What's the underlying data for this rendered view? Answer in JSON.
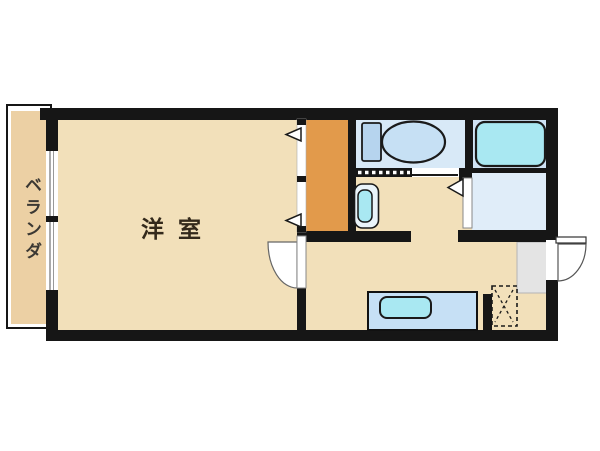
{
  "title": "apartment-floor-plan",
  "labels": {
    "western_room": "洋室",
    "balcony": "ベランダ"
  },
  "fixtures": [
    "toilet-icon",
    "bathtub-icon",
    "washbasin-icon",
    "kitchen-sink-icon",
    "refrigerator-space-icon",
    "balcony-window",
    "sliding-door",
    "room-door-swing",
    "entry-door-swing",
    "closet-door-arrow",
    "washroom-door-arrow"
  ],
  "colors": {
    "floor": "#f2e0ba",
    "balcony": "#ecd0a4",
    "closet": "#e29a4b",
    "toilet_room": "#d8e9f7",
    "bath_room": "#cfe3f5",
    "wash_room": "#e0edf9",
    "entry": "#e4e4e4",
    "counter": "#c6e0f5",
    "fixture_cyan": "#a9e8f2",
    "fixture_blue": "#b6d4ee",
    "bowl_blue": "#c6e0f4",
    "basin_outer": "#eaf4fa",
    "wall": "#161616",
    "label_text": "#33291b",
    "balcony_text": "#3b3833"
  }
}
